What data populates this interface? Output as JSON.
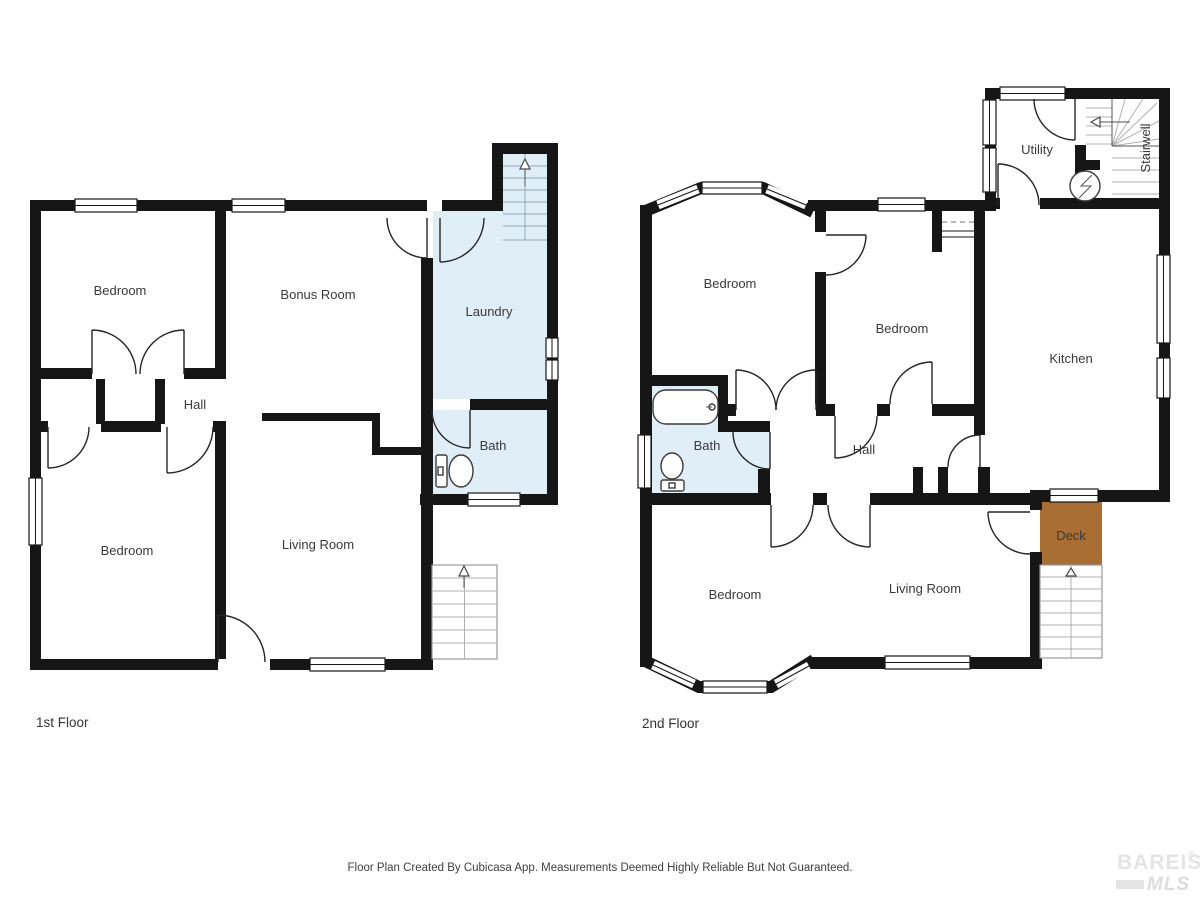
{
  "page": {
    "background": "#ffffff"
  },
  "colors": {
    "wall": "#161616",
    "wet_room_fill": "#e0eef8",
    "deck_fill": "#a96e33",
    "label_text": "#3a3a3a",
    "indoor_stair_line": "#93a9b9",
    "outdoor_stair_line": "#b0b0b0",
    "watermark": "#e4e4e4"
  },
  "floors": {
    "first": {
      "title": "1st Floor",
      "rooms": {
        "bedroom_top": "Bedroom",
        "bonus_room": "Bonus Room",
        "laundry": "Laundry",
        "hall": "Hall",
        "bedroom_bottom": "Bedroom",
        "living_room": "Living Room",
        "bath": "Bath"
      }
    },
    "second": {
      "title": "2nd Floor",
      "rooms": {
        "bedroom_top": "Bedroom",
        "bedroom_mid": "Bedroom",
        "utility": "Utility",
        "stairwell": "Stairwell",
        "kitchen": "Kitchen",
        "bath": "Bath",
        "hall": "Hall",
        "bedroom_bottom": "Bedroom",
        "living_room": "Living Room",
        "deck": "Deck"
      }
    }
  },
  "footer": {
    "disclaimer": "Floor Plan Created By Cubicasa App. Measurements Deemed Highly Reliable But Not Guaranteed."
  },
  "watermark": {
    "brand": "BAREIS",
    "registered_mark": "®",
    "suffix": "MLS"
  }
}
